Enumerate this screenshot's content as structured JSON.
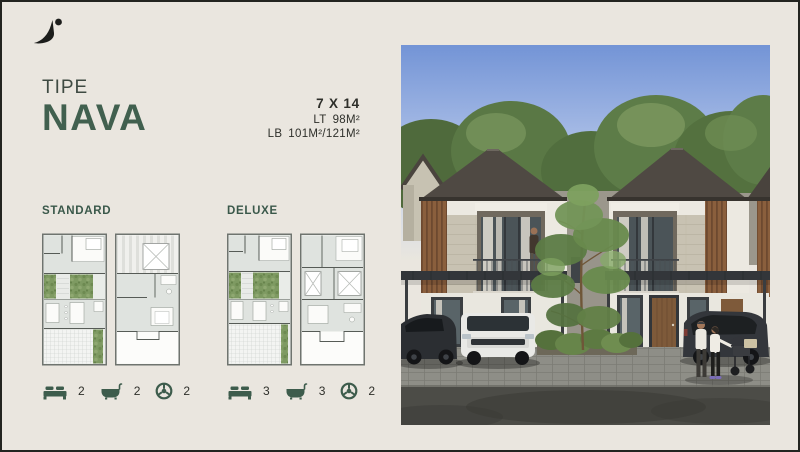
{
  "header": {
    "kicker": "TIPE",
    "title": "NAVA"
  },
  "specs": {
    "dimensions": "7 X 14",
    "lt_label": "LT",
    "lt_value": "98M²",
    "lb_label": "LB",
    "lb_value": "101M²/121M²"
  },
  "variants": [
    {
      "name": "STANDARD",
      "bedrooms": "2",
      "bathrooms": "2",
      "carports": "2"
    },
    {
      "name": "DELUXE",
      "bedrooms": "3",
      "bathrooms": "3",
      "carports": "2"
    }
  ],
  "icons": {
    "logo": "brand-swoosh-with-dot",
    "bedrooms": "bed-icon",
    "bathrooms": "bathtub-icon",
    "carports": "steering-wheel-icon"
  },
  "colors": {
    "background_cream": "#eae6df",
    "border_dark": "#232420",
    "accent_green": "#41604f",
    "label_green": "#3a584a",
    "text_dark": "#2e2f2a",
    "icon_green": "#3d5c4c",
    "sky_blue": "#7394d6",
    "roof_brown": "#4f4943",
    "wood_slat": "#8a5f3d",
    "plan_moss_green": "#7e9a62"
  }
}
